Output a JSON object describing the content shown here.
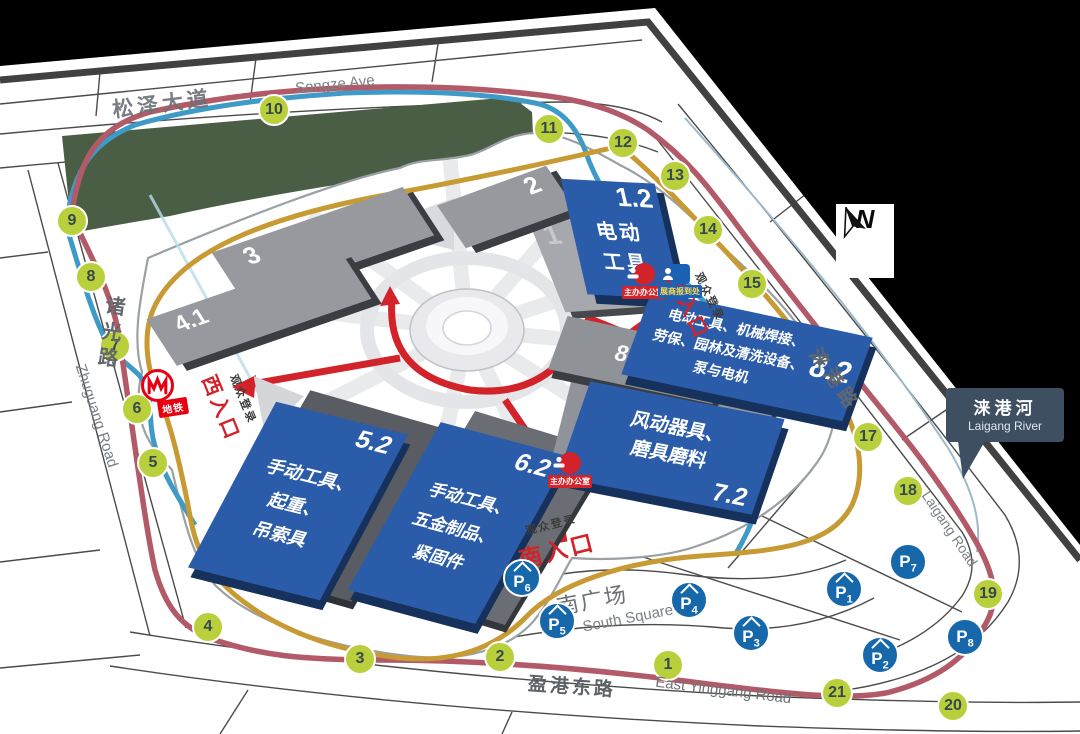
{
  "map": {
    "compass_label": "N",
    "roads": {
      "songze": {
        "zh": "松泽大道",
        "en": "Songze Ave"
      },
      "zhuguang": {
        "zh": "诸光路",
        "en": "Zhuguang Road"
      },
      "yinggang": {
        "zh": "盈港东路",
        "en": "East Yinggang Road"
      },
      "laigang": {
        "zh": "涞港路",
        "en": "Laigang Road"
      }
    },
    "river_callout": {
      "zh": "涞港河",
      "en": "Laigang River"
    },
    "square": {
      "zh": "南广场",
      "en": "South Square"
    },
    "entrances": [
      {
        "id": "west",
        "name": "西入口",
        "note": "观众登录"
      },
      {
        "id": "south",
        "name": "南入口",
        "note": "观众登录"
      },
      {
        "id": "east",
        "name": "东入口",
        "note": "观众登录"
      }
    ],
    "metro": {
      "label": "地铁"
    },
    "service_points": [
      {
        "id": "organizer-east",
        "label": "主办办公室",
        "type": "organizer"
      },
      {
        "id": "exhibitor-east",
        "label": "展商报到处",
        "type": "exhibitor"
      },
      {
        "id": "organizer-south",
        "label": "主办办公室",
        "type": "organizer"
      }
    ],
    "halls": [
      {
        "id": "2",
        "type": "gray",
        "lines": []
      },
      {
        "id": "3",
        "type": "gray",
        "lines": []
      },
      {
        "id": "4.1",
        "type": "gray",
        "lines": []
      },
      {
        "id": "8.1",
        "type": "gray",
        "lines": []
      },
      {
        "id": "1.2",
        "type": "blue",
        "lines": [
          "电动",
          "工具"
        ]
      },
      {
        "id": "8.2",
        "type": "blue",
        "lines": [
          "电动工具、机械焊接、",
          "劳保、园林及清洗设备、",
          "泵与电机"
        ]
      },
      {
        "id": "5.2",
        "type": "blue",
        "lines": [
          "手动工具、",
          "起重、",
          "吊索具"
        ]
      },
      {
        "id": "6.2",
        "type": "blue",
        "lines": [
          "手动工具、",
          "五金制品、",
          "紧固件"
        ]
      },
      {
        "id": "7.2",
        "type": "blue",
        "lines": [
          "风动器具、",
          "磨具磨料"
        ]
      }
    ],
    "ghost_halls": [
      "1",
      "5.1",
      "7.1"
    ],
    "gates": [
      "1",
      "2",
      "3",
      "4",
      "5",
      "6",
      "7",
      "8",
      "9",
      "10",
      "11",
      "12",
      "13",
      "14",
      "15",
      "16",
      "17",
      "18",
      "19",
      "20",
      "21"
    ],
    "parking": [
      {
        "id": "P1",
        "covered": true
      },
      {
        "id": "P2",
        "covered": true
      },
      {
        "id": "P3",
        "covered": true
      },
      {
        "id": "P4",
        "covered": true
      },
      {
        "id": "P5",
        "covered": true
      },
      {
        "id": "P6",
        "covered": true
      },
      {
        "id": "P7",
        "covered": false
      },
      {
        "id": "P8",
        "covered": false
      }
    ]
  },
  "colors": {
    "gate_green": "#b9cf3b",
    "parking_blue": "#1668ab",
    "hall_blue": "#2b5ca9",
    "hall_gray": "#97999e",
    "route_red": "#b25a68",
    "route_blue": "#3e9ac6",
    "route_gold": "#c79a33",
    "arrow_red": "#d2232a",
    "metro_red": "#e60012",
    "park_green": "#4a5d45",
    "callout_slate": "#3e4f62"
  }
}
